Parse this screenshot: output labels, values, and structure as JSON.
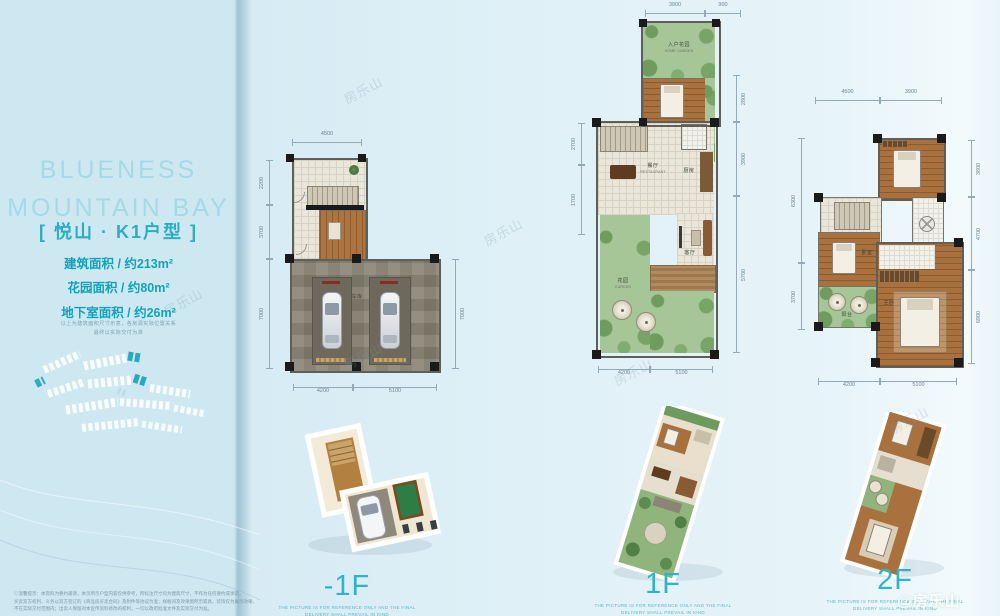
{
  "page": {
    "watermark": "房乐山",
    "watermark_badge": "@房乐山"
  },
  "sidebar": {
    "title1": "BLUENESS",
    "title2": "MOUNTAIN BAY",
    "unit": "[ 悦山 · K1户型 ]",
    "spec_lines": [
      "建筑面积 / 约213m²",
      "花园面积 / 约80m²",
      "地下室面积 / 约26m²"
    ],
    "note1": "以上为建筑面积尺寸示意，各房源实际位置关系",
    "note2": "最终以实际交付为准",
    "disc1": "◎温馨提示：本资料为要约邀请，本页所示户型内容仅供参考，所标注尺寸均为建筑尺寸，不作为任何要约或承诺，",
    "disc2": "买卖双方权利、义务以双方签订的《商品房买卖合同》及附件等协议为准；样板间及效果图所示家具、装饰仅为展示效果，",
    "disc3": "不在实际交付范围内；出卖人保留对本宣传资料修改的权利，一切以政府批准文件及实际交付为准。"
  },
  "plans": {
    "caption1": "THE PICTURE IS FOR REFERENCE ONLY AND THE FINAL",
    "caption2": "DELIVERY SHALL PREVAIL IN KIND",
    "b1": {
      "label": "-1F",
      "dims": {
        "top": [
          "4500"
        ],
        "left": [
          "2200",
          "3700",
          "7000"
        ],
        "right": [
          "7000"
        ],
        "bottom": [
          "4200",
          "5100"
        ]
      },
      "rooms": {
        "garage": "车库"
      }
    },
    "f1": {
      "label": "1F",
      "dims": {
        "top": [
          "3900",
          "900"
        ],
        "left": [
          "2700",
          "1700"
        ],
        "right": [
          "2800",
          "3900",
          "5700"
        ],
        "bottom": [
          "4200",
          "5100"
        ]
      },
      "rooms": {
        "entry_garden": "入户花园",
        "entry_garden_en": "HOME GARDEN",
        "dining": "餐厅",
        "dining_en": "RESTAURANT",
        "kitchen": "厨房",
        "living": "客厅",
        "garden": "花园",
        "garden_en": "GARDEN"
      }
    },
    "f2": {
      "label": "2F",
      "dims": {
        "top": [
          "4500",
          "3900"
        ],
        "left": [
          "6300",
          "3700"
        ],
        "right": [
          "3800",
          "4700",
          "6900"
        ],
        "bottom": [
          "4200",
          "5100"
        ]
      },
      "rooms": {
        "master": "主卧",
        "bedroom": "卧室",
        "balcony": "阳台"
      }
    }
  }
}
